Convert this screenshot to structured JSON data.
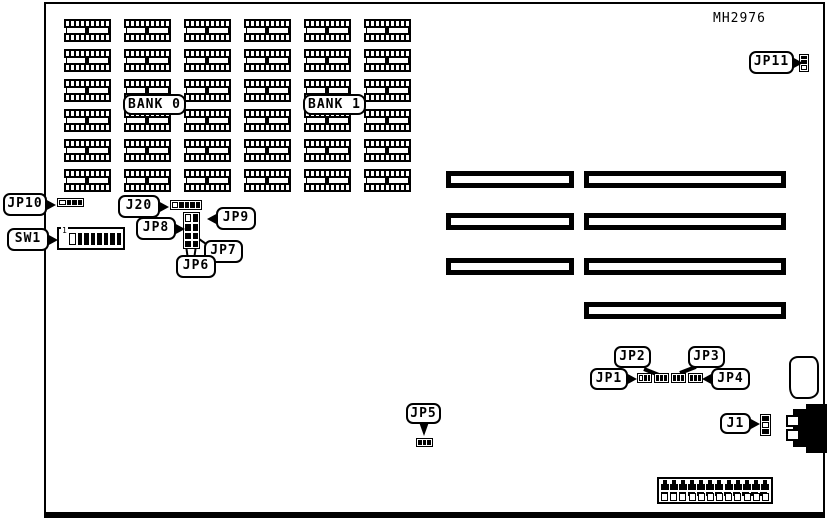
{
  "diagram": {
    "part_number": "MH2976"
  },
  "memory": {
    "bank0_label": "BANK 0",
    "bank1_label": "BANK 1",
    "chip_rows": 6,
    "chip_cols": 6
  },
  "expansion_slots": {
    "left_column_count": 3,
    "right_column_count": 4
  },
  "callouts": {
    "jp1": "JP1",
    "jp2": "JP2",
    "jp3": "JP3",
    "jp4": "JP4",
    "jp5": "JP5",
    "jp6": "JP6",
    "jp7": "JP7",
    "jp8": "JP8",
    "jp9": "JP9",
    "jp10": "JP10",
    "jp11": "JP11",
    "j1": "J1",
    "j20": "J20",
    "sw1": "SW1"
  },
  "dip_switch": {
    "positions": 8,
    "index_label": "1"
  },
  "power_connector": {
    "top_pin_count": 12,
    "bottom_cell_count": 12
  },
  "connectors": {
    "jp10_cells": "obbb",
    "j20_cells": "obbbb",
    "jp8_grid": [
      "ob",
      "bb",
      "bb",
      "bb"
    ],
    "jp11_cells": "bbo",
    "j1_cells": "bob",
    "jp1_cells": "obb",
    "jp2_cells": "bbb",
    "jp3_cells": "bbb",
    "jp4_cells": "bbb",
    "jp5_cells": "bbb"
  }
}
